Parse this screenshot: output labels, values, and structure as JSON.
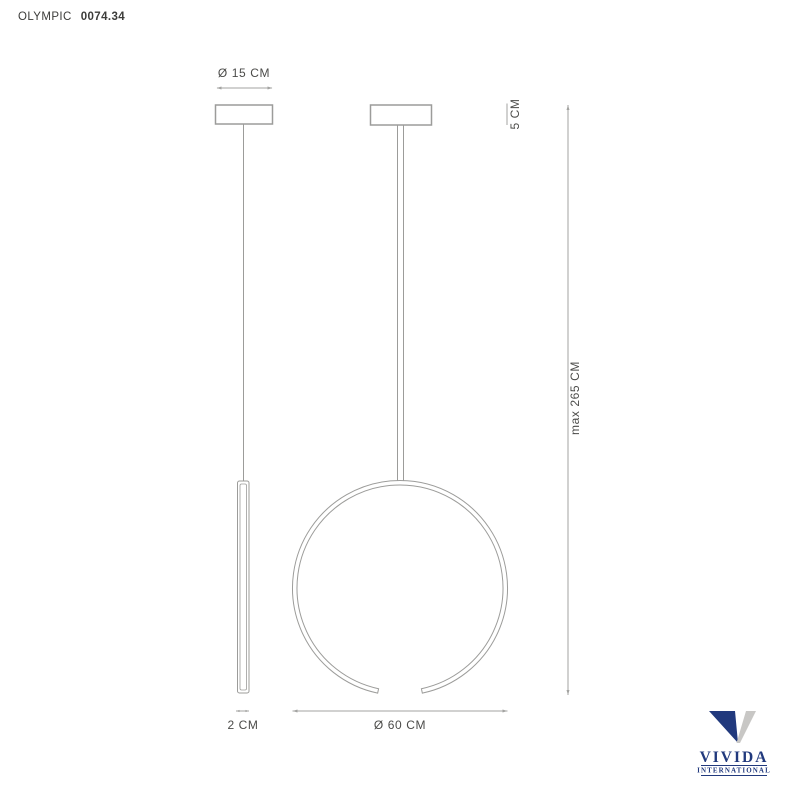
{
  "header": {
    "product_name": "OLYMPIC",
    "product_code": "0074.34"
  },
  "dimensions": {
    "canopy_diameter_label": "Ø 15 CM",
    "canopy_height_label": "5 CM",
    "max_drop_label": "max 265 CM",
    "profile_width_label": "2 CM",
    "ring_diameter_label": "Ø 60 CM"
  },
  "logo": {
    "brand": "VIVIDA",
    "subtitle": "INTERNATIONAL"
  },
  "colors": {
    "drawing_line": "#9c9c9a",
    "dimension_line": "#a3a3a1",
    "label_text": "#4b4b49",
    "logo_navy": "#21397d",
    "logo_silver": "#c8c7c5"
  }
}
